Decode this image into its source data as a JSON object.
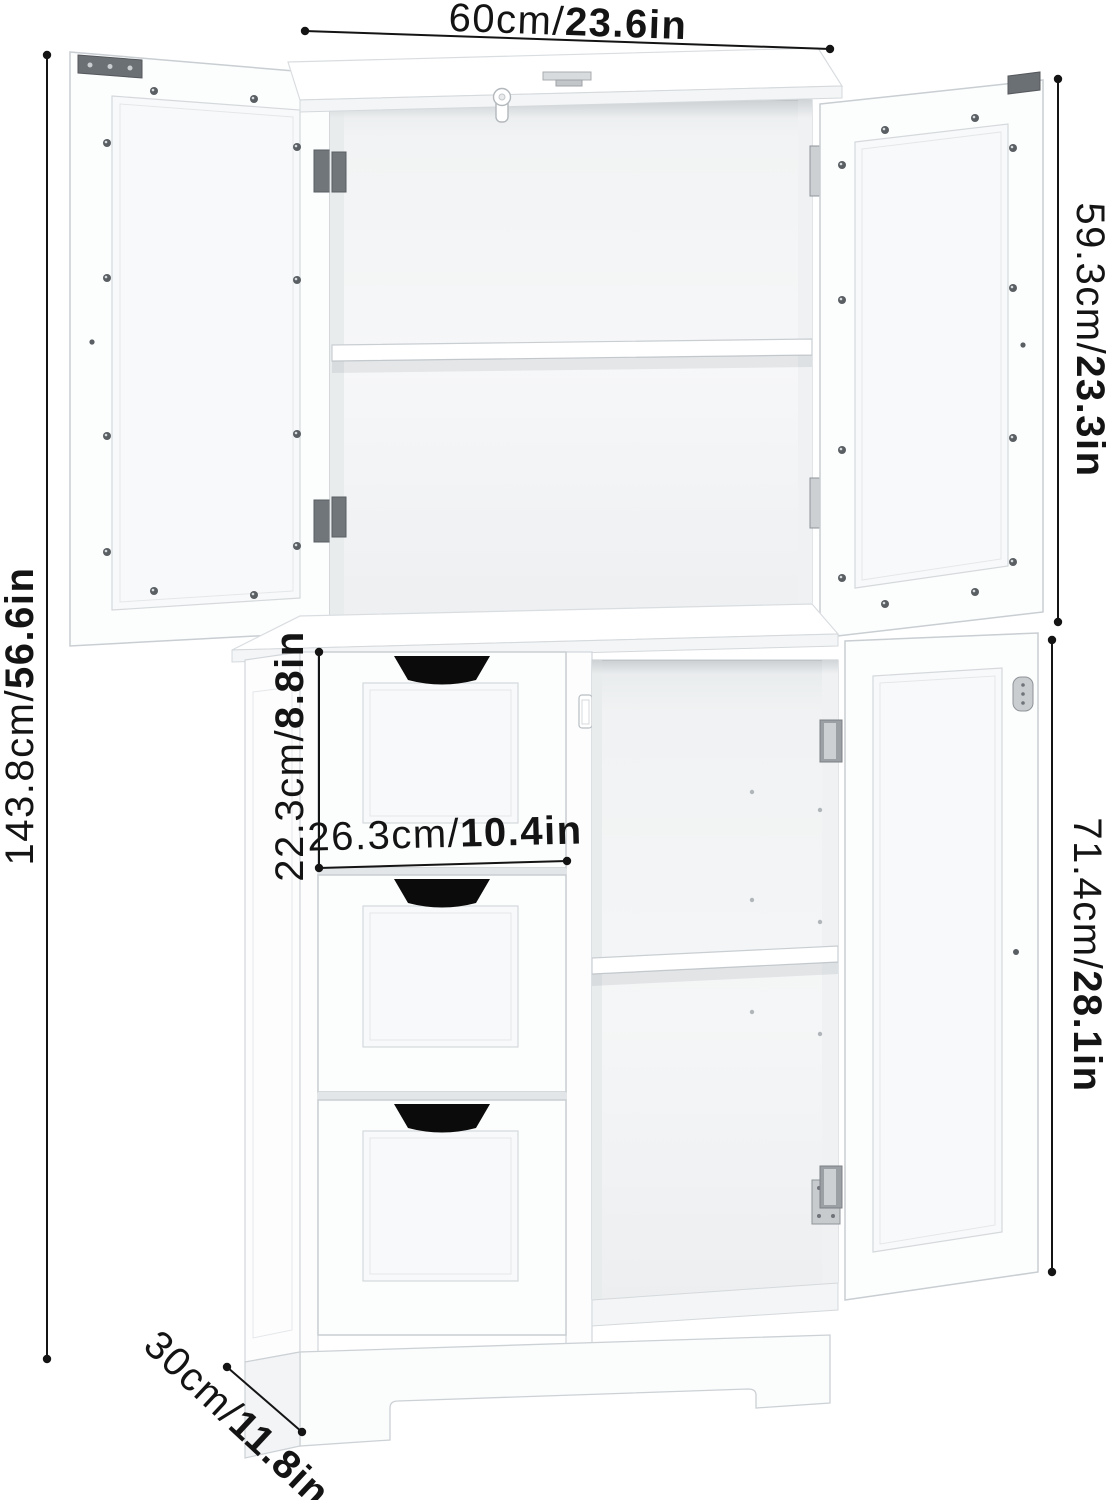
{
  "type": "product-dimension-diagram",
  "subject": "white-bathroom-storage-cabinet",
  "colors": {
    "background": "#ffffff",
    "dimension": "#141414",
    "handle_cutout": "#0b0b0b",
    "hinge_dark": "#71767b",
    "hinge_silver": "#ccd0d3",
    "cabinet_outline": "#c9ced2"
  },
  "dimensions": {
    "width_top": {
      "metric": "60cm/",
      "imperial": "23.6in"
    },
    "upper_cabinet_height": {
      "metric": "59.3cm/",
      "imperial": "23.3in"
    },
    "overall_height": {
      "metric": "143.8cm/",
      "imperial": "56.6in"
    },
    "drawer_height": {
      "metric": "22.3cm/",
      "imperial": "8.8in"
    },
    "drawer_width": {
      "metric": "26.3cm/",
      "imperial": "10.4in"
    },
    "lower_cabinet_height": {
      "metric": "71.4cm/",
      "imperial": "28.1in"
    },
    "depth": {
      "metric": "30cm/",
      "imperial": "11.8in"
    }
  }
}
